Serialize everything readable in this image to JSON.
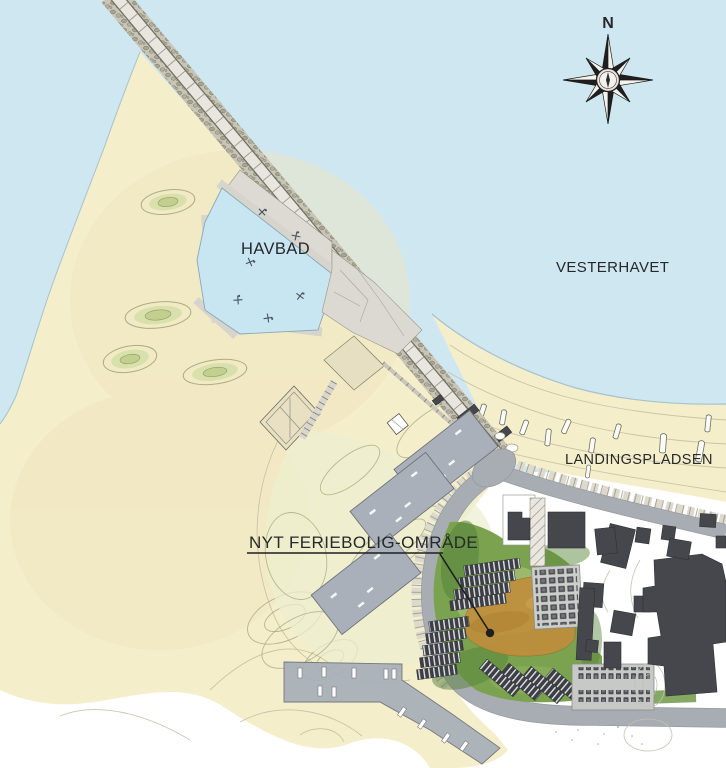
{
  "map": {
    "labels": {
      "compass_north": "N",
      "sea_bath": "HAVBAD",
      "sea_name": "VESTERHAVET",
      "landing_place": "LANDINGSPLADSEN",
      "new_holiday_area": "NYT FERIEBOLIG-OMRÅDE"
    },
    "colors": {
      "water": "#cfe7f1",
      "sand": "#f5eecb",
      "pool": "#c8e6f2",
      "road": "#a8adb3",
      "paving": "#dbd9d1",
      "deck": "#e7dfc2",
      "gray_building": "#a9b0b9",
      "dark_building": "#45474c",
      "roof": "#3c4046",
      "green": "#7aa24f",
      "orange": "#bf8e3d",
      "dune_green": "#ccd79e",
      "parking": "#cbcec9",
      "ink": "#1d1f21"
    }
  }
}
